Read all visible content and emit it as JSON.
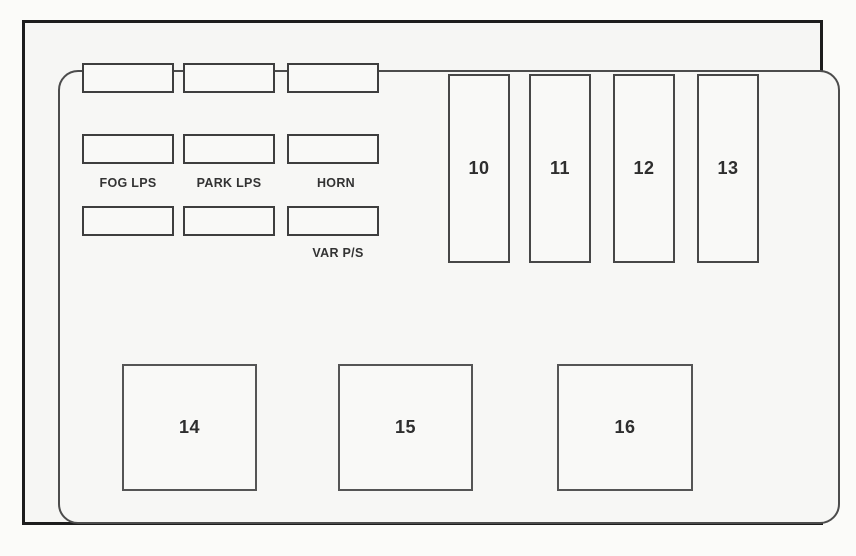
{
  "relay_labels": {
    "fog": "FOG LPS",
    "park": "PARK LPS",
    "horn": "HORN",
    "var_ps": "VAR P/S"
  },
  "vertical_fuses": [
    "10",
    "11",
    "12",
    "13"
  ],
  "bottom_relays": [
    "14",
    "15",
    "16"
  ],
  "colors": {
    "outer_frame_border": "#1d1d1d",
    "inner_panel_border": "#4c4c4c",
    "slot_border": "#3e3e3e",
    "text": "#2e2e2e",
    "background": "#f6f6f4"
  }
}
